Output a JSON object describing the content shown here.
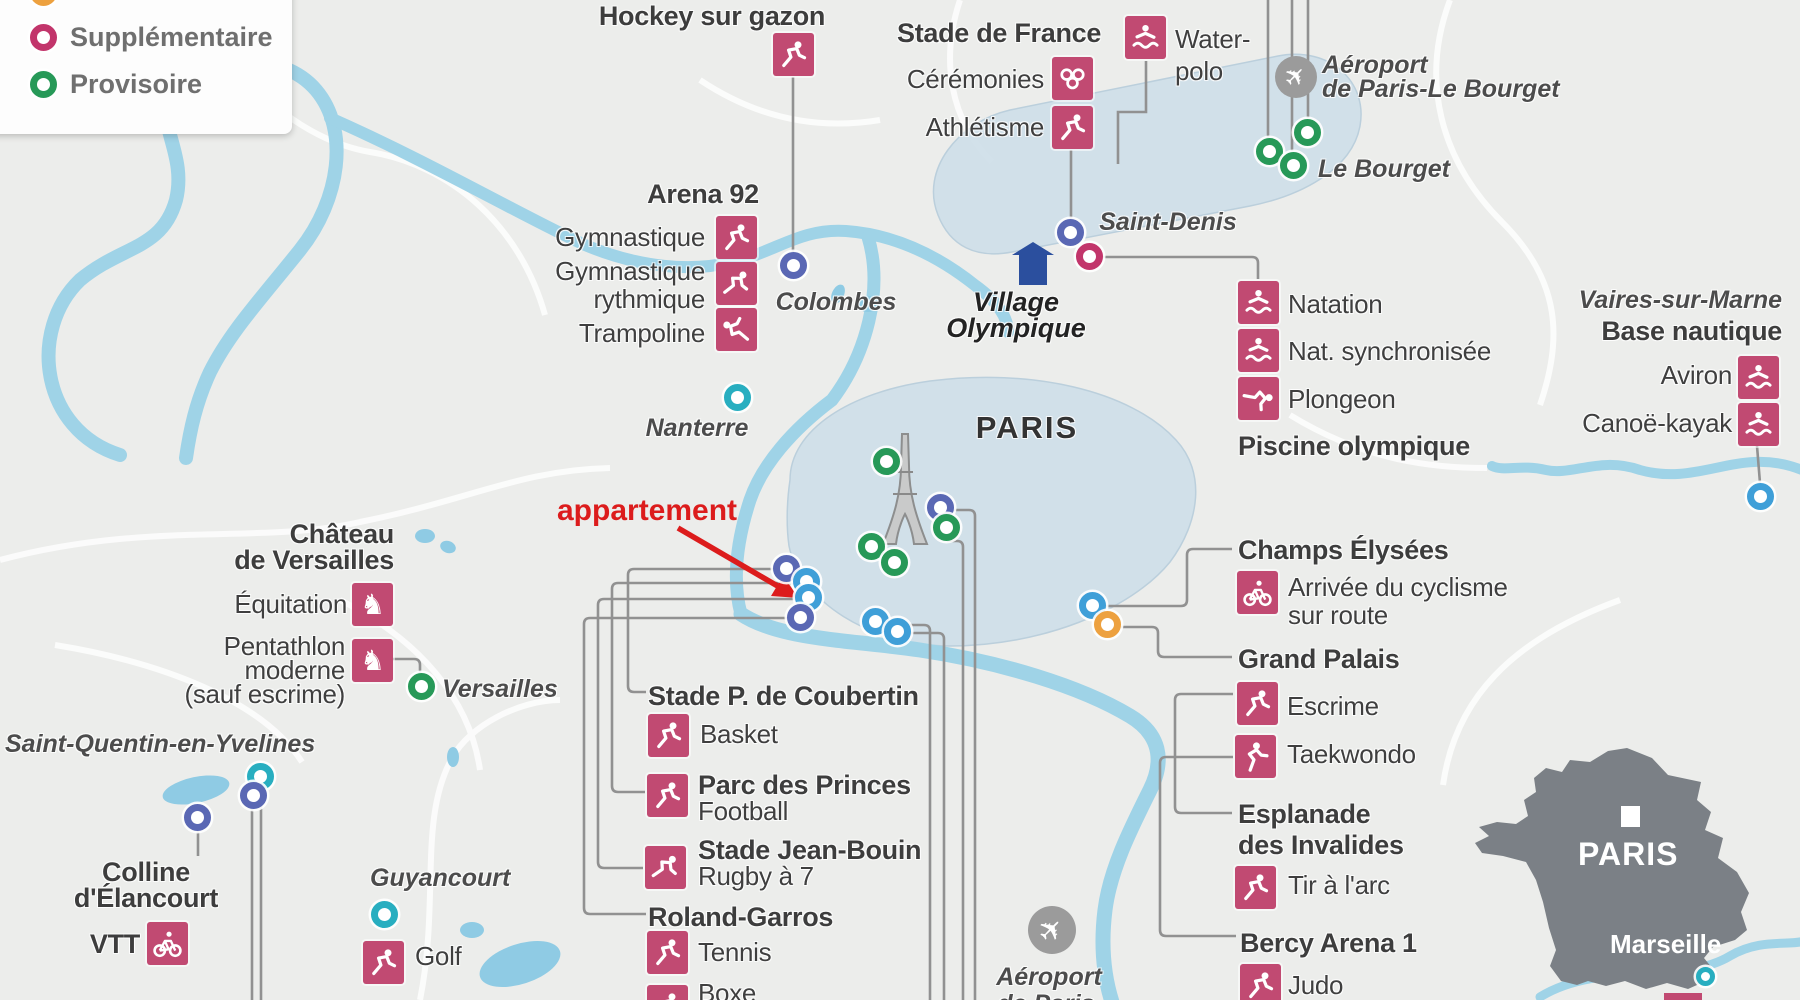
{
  "legend": {
    "items": [
      {
        "label": "Supplémentaire",
        "ring_color": "#c2356b"
      },
      {
        "label": "Provisoire",
        "ring_color": "#279958"
      }
    ],
    "partial_item_ring_color": "#e8a43c"
  },
  "annotation": {
    "label": "appartement",
    "color": "#dc1c1c"
  },
  "marker_colors": {
    "indigo": "#5a68b4",
    "blue": "#3f9fd8",
    "teal": "#28aec0",
    "green": "#279958",
    "pink": "#c2356b",
    "orange": "#eda13f"
  },
  "icon_tile_color": "#c14a72",
  "labels": {
    "hockey": "Hockey sur gazon",
    "arena92": "Arena 92",
    "gymnastique": "Gymnastique",
    "gym_rythmique_1": "Gymnastique",
    "gym_rythmique_2": "rythmique",
    "trampoline": "Trampoline",
    "colombes": "Colombes",
    "nanterre": "Nanterre",
    "stade_de_france": "Stade de France",
    "ceremonies": "Cérémonies",
    "athletisme": "Athlétisme",
    "water_polo_1": "Water-",
    "water_polo_2": "polo",
    "saint_denis": "Saint-Denis",
    "village_1": "Village",
    "village_2": "Olympique",
    "aeroport_lb_1": "Aéroport",
    "aeroport_lb_2": "de Paris-Le Bourget",
    "le_bourget": "Le Bourget",
    "natation": "Natation",
    "nat_synchronisee": "Nat. synchronisée",
    "plongeon": "Plongeon",
    "piscine": "Piscine olympique",
    "vaires": "Vaires-sur-Marne",
    "base_nautique": "Base nautique",
    "aviron": "Aviron",
    "canoe": "Canoë-kayak",
    "paris": "PARIS",
    "champs": "Champs Élysées",
    "arrivee_1": "Arrivée du cyclisme",
    "arrivee_2": "sur route",
    "grand_palais": "Grand Palais",
    "escrime": "Escrime",
    "taekwondo": "Taekwondo",
    "esplanade_1": "Esplanade",
    "esplanade_2": "des Invalides",
    "tir": "Tir à l'arc",
    "bercy": "Bercy Arena 1",
    "judo": "Judo",
    "aeroport_paris_1": "Aéroport",
    "aeroport_paris_2": "de Paris",
    "chateau_1": "Château",
    "chateau_2": "de Versailles",
    "equitation": "Équitation",
    "pentathlon_1": "Pentathlon",
    "pentathlon_2": "moderne",
    "pentathlon_3": "(sauf escrime)",
    "versailles": "Versailles",
    "sqy": "Saint-Quentin-en-Yvelines",
    "colline_1": "Colline",
    "colline_2": "d'Élancourt",
    "vtt": "VTT",
    "guyancourt": "Guyancourt",
    "golf": "Golf",
    "coubertin": "Stade P. de Coubertin",
    "basket": "Basket",
    "parc_princes": "Parc des Princes",
    "football": "Football",
    "jean_bouin": "Stade Jean-Bouin",
    "rugby": "Rugby à 7",
    "roland_garros": "Roland-Garros",
    "tennis": "Tennis",
    "boxe": "Boxe",
    "inset_paris": "PARIS",
    "inset_marseille": "Marseille"
  }
}
